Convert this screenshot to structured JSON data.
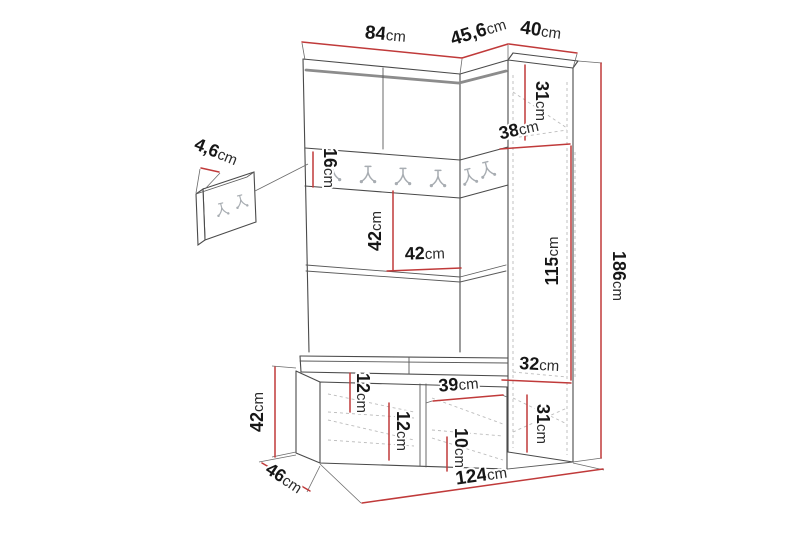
{
  "page": {
    "background": "#ffffff",
    "description": "Dimensional line drawing of a hallway wardrobe set with bench, corner side cabinet, hook rail and separate wall hook panel"
  },
  "colors": {
    "dimension_line": "#c03a3a",
    "outline": "#4a4a4a",
    "hidden_line": "#bcbcbc",
    "thick_accent": "#8c8c8c",
    "hook": "#a8adb2",
    "label_text": "#161616"
  },
  "icons": {
    "coat_hook": "double-prong-coat-hook"
  },
  "dims": {
    "d84": {
      "v": "84",
      "u": "cm"
    },
    "d45_6": {
      "v": "45,6",
      "u": "cm"
    },
    "d40": {
      "v": "40",
      "u": "cm"
    },
    "d31_top": {
      "v": "31",
      "u": "cm"
    },
    "d38": {
      "v": "38",
      "u": "cm"
    },
    "d16": {
      "v": "16",
      "u": "cm"
    },
    "d42_mid_v": {
      "v": "42",
      "u": "cm"
    },
    "d42_mid_h": {
      "v": "42",
      "u": "cm"
    },
    "d115": {
      "v": "115",
      "u": "cm"
    },
    "d186": {
      "v": "186",
      "u": "cm"
    },
    "d32": {
      "v": "32",
      "u": "cm"
    },
    "d31_bottom": {
      "v": "31",
      "u": "cm"
    },
    "d12_top": {
      "v": "12",
      "u": "cm"
    },
    "d12_left": {
      "v": "12",
      "u": "cm"
    },
    "d39": {
      "v": "39",
      "u": "cm"
    },
    "d10": {
      "v": "10",
      "u": "cm"
    },
    "d42_bench": {
      "v": "42",
      "u": "cm"
    },
    "d46": {
      "v": "46",
      "u": "cm"
    },
    "d124": {
      "v": "124",
      "u": "cm"
    },
    "d4_6": {
      "v": "4,6",
      "u": "cm"
    }
  }
}
